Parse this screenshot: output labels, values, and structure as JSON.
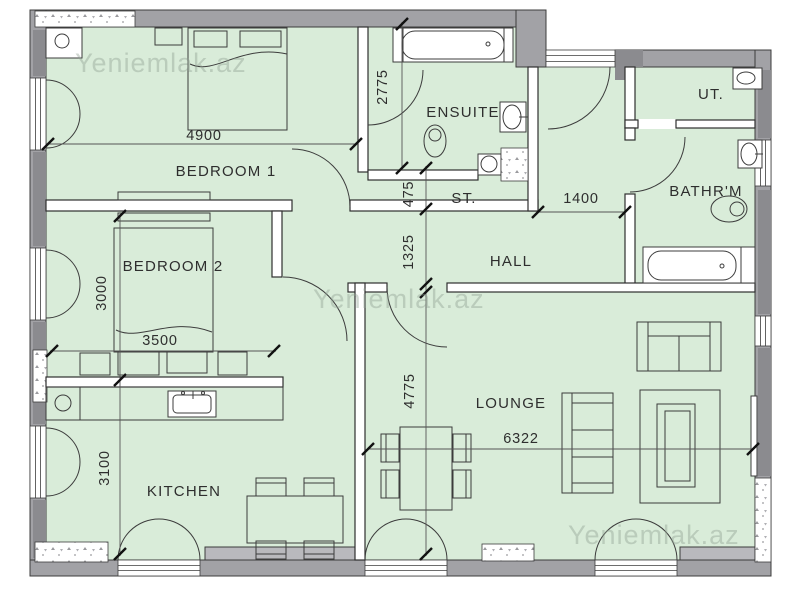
{
  "plan": {
    "watermark": "Yeniemlak.az",
    "rooms": {
      "bedroom1": "BEDROOM 1",
      "bedroom2": "BEDROOM 2",
      "ensuite": "ENSUITE",
      "storage": "ST.",
      "hall": "HALL",
      "bathroom": "BATHR'M",
      "utility": "UT.",
      "lounge": "LOUNGE",
      "kitchen": "KITCHEN"
    },
    "dimensions": {
      "bedroom1_width": "4900",
      "ensuite_length": "2775",
      "storage_depth": "475",
      "hall_width": "1400",
      "hall_length": "1325",
      "bedroom2_length": "3000",
      "bedroom2_width": "3500",
      "lounge_length": "4775",
      "kitchen_length": "3100",
      "lounge_width": "6322"
    },
    "colors": {
      "floor": "#d9ecd9",
      "wall_gray": "#a2a2a6",
      "wall_dark": "#8b8b8f",
      "wall_sill": "#b9b9bd",
      "line": "#3c3c3c",
      "watermark": "#8fa091"
    }
  }
}
